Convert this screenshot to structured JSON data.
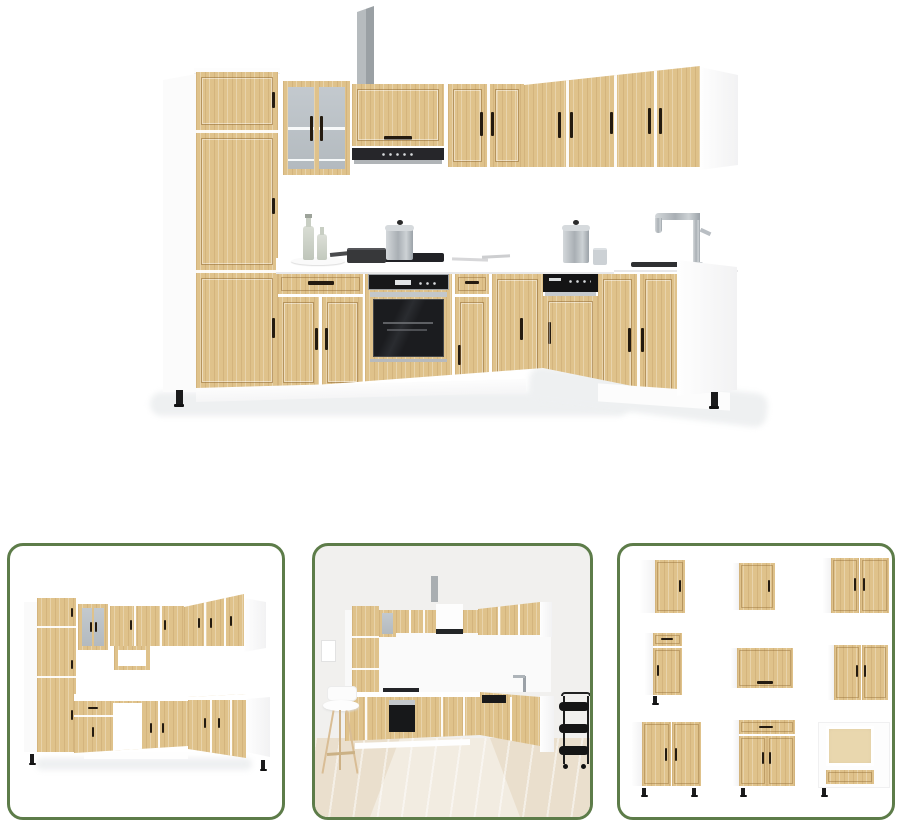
{
  "gallery": {
    "background": "#ffffff",
    "main_image": {
      "label": "kitchen-cabinet-set-sonoma-oak-l-shaped-with-appliances"
    },
    "thumbnails": [
      {
        "label": "kitchen-cabinet-set-isolated-front-view"
      },
      {
        "label": "kitchen-cabinet-set-room-scene"
      },
      {
        "label": "kitchen-cabinet-individual-units-grid"
      }
    ]
  },
  "colors": {
    "accent_green": "#5d7c49",
    "wood": "#dfc28b",
    "handle_dark": "#241b10",
    "appliance_black": "#17181a",
    "steel_gray": "#b9bec3",
    "glass_gray": "#bcc2c7",
    "wall_gray": "#f1f0ee",
    "floor_wood": "#eadfcd",
    "panel_white": "#fbfbfb",
    "shadow_gray": "#eef0f1"
  }
}
